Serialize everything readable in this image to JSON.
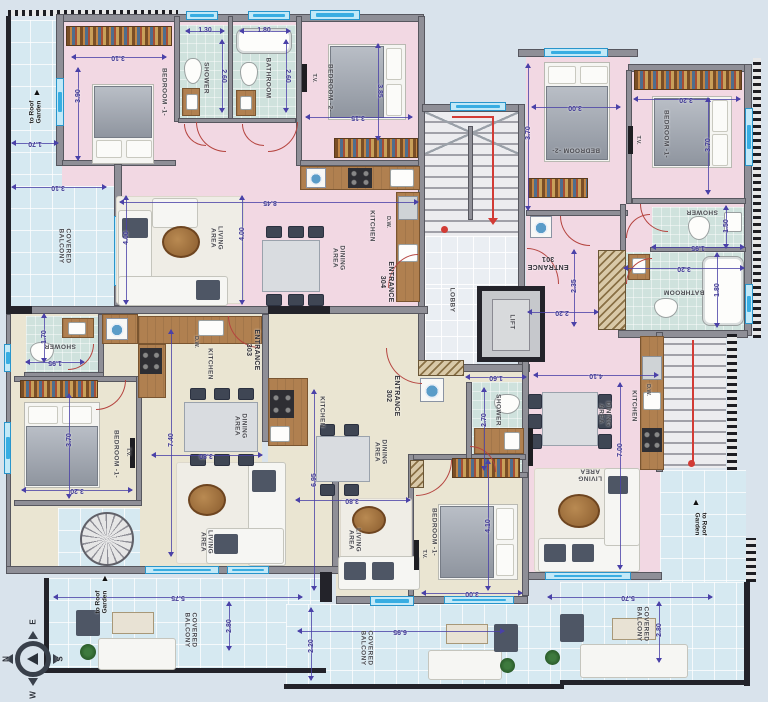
{
  "colors": {
    "pink_unit": "#f2d8e3",
    "beige_unit": "#eae5d2",
    "wet_room_tile": "#cfe2dd",
    "balcony_tile": "#d6e9f1",
    "wall": "#8f8f97",
    "dimension": "#3f3894",
    "door_swing": "#b5443f",
    "window": "#38ade2",
    "stair_path": "#d23b35"
  },
  "labels": [
    {
      "t": "BEDROOM -1-",
      "x": 164,
      "y": 92,
      "r": 90,
      "c": "room"
    },
    {
      "t": "SHOWER",
      "x": 206,
      "y": 78,
      "r": 90,
      "c": "room"
    },
    {
      "t": "BATHROOM",
      "x": 268,
      "y": 78,
      "r": 90,
      "c": "room"
    },
    {
      "t": "BEDROOM -2-",
      "x": 330,
      "y": 88,
      "r": 90,
      "c": "room"
    },
    {
      "t": "LIVING\nAREA",
      "x": 216,
      "y": 238,
      "r": 90,
      "c": "room"
    },
    {
      "t": "DINING\nAREA",
      "x": 338,
      "y": 258,
      "r": 90,
      "c": "room"
    },
    {
      "t": "KITCHEN",
      "x": 372,
      "y": 226,
      "r": 90,
      "c": "room"
    },
    {
      "t": "BEDROOM -2-",
      "x": 576,
      "y": 150,
      "r": 180,
      "c": "room"
    },
    {
      "t": "BEDROOM -1-",
      "x": 666,
      "y": 134,
      "r": 90,
      "c": "room"
    },
    {
      "t": "SHOWER",
      "x": 702,
      "y": 212,
      "r": 180,
      "c": "room"
    },
    {
      "t": "BATHROOM",
      "x": 684,
      "y": 292,
      "r": 180,
      "c": "room"
    },
    {
      "t": "DINING\nAREA",
      "x": 604,
      "y": 414,
      "r": 90,
      "c": "room"
    },
    {
      "t": "KITCHEN",
      "x": 634,
      "y": 406,
      "r": 90,
      "c": "room"
    },
    {
      "t": "LIVING\nAREA",
      "x": 590,
      "y": 474,
      "r": 180,
      "c": "room"
    },
    {
      "t": "LOBBY",
      "x": 452,
      "y": 300,
      "r": 90,
      "c": "room"
    },
    {
      "t": "LIFT",
      "x": 512,
      "y": 322,
      "r": 90,
      "c": "room"
    },
    {
      "t": "SHOWER",
      "x": 60,
      "y": 346,
      "r": 180,
      "c": "room"
    },
    {
      "t": "BEDROOM -1-",
      "x": 116,
      "y": 454,
      "r": 90,
      "c": "room"
    },
    {
      "t": "KITCHEN",
      "x": 210,
      "y": 364,
      "r": 90,
      "c": "room"
    },
    {
      "t": "DINING\nAREA",
      "x": 240,
      "y": 426,
      "r": 90,
      "c": "room"
    },
    {
      "t": "LIVING\nAREA",
      "x": 206,
      "y": 542,
      "r": 90,
      "c": "room"
    },
    {
      "t": "KITCHEN",
      "x": 322,
      "y": 412,
      "r": 90,
      "c": "room"
    },
    {
      "t": "DINING\nAREA",
      "x": 380,
      "y": 452,
      "r": 90,
      "c": "room"
    },
    {
      "t": "LIVING\nAREA",
      "x": 354,
      "y": 540,
      "r": 90,
      "c": "room"
    },
    {
      "t": "BEDROOM -1-",
      "x": 434,
      "y": 532,
      "r": 90,
      "c": "room"
    },
    {
      "t": "SHOWER",
      "x": 498,
      "y": 410,
      "r": 90,
      "c": "room"
    },
    {
      "t": "COVERED\nBALCONY",
      "x": 64,
      "y": 246,
      "r": 90,
      "c": "room"
    },
    {
      "t": "COVERED\nBALCONY",
      "x": 190,
      "y": 630,
      "r": 90,
      "c": "room"
    },
    {
      "t": "COVERED\nBALCONY",
      "x": 366,
      "y": 648,
      "r": 90,
      "c": "room"
    },
    {
      "t": "COVERED\nBALCONY",
      "x": 642,
      "y": 624,
      "r": 90,
      "c": "room"
    },
    {
      "t": "ENTRANCE\n304",
      "x": 386,
      "y": 282,
      "r": 90,
      "c": "ent"
    },
    {
      "t": "ENTRANCE\n301",
      "x": 548,
      "y": 262,
      "r": 180,
      "c": "ent"
    },
    {
      "t": "ENTRANCE\n303",
      "x": 252,
      "y": 350,
      "r": 90,
      "c": "ent"
    },
    {
      "t": "ENTRANCE\n302",
      "x": 392,
      "y": 396,
      "r": 90,
      "c": "ent"
    },
    {
      "t": "T.V.",
      "x": 314,
      "y": 78,
      "r": 90,
      "c": "tiny"
    },
    {
      "t": "T.V.",
      "x": 638,
      "y": 140,
      "r": 90,
      "c": "tiny"
    },
    {
      "t": "T.V.",
      "x": 128,
      "y": 452,
      "r": 90,
      "c": "tiny"
    },
    {
      "t": "T.V.",
      "x": 424,
      "y": 554,
      "r": 90,
      "c": "tiny"
    },
    {
      "t": "D.W.",
      "x": 388,
      "y": 222,
      "r": 90,
      "c": "tiny"
    },
    {
      "t": "D.W.",
      "x": 648,
      "y": 390,
      "r": 90,
      "c": "tiny"
    },
    {
      "t": "D.W.",
      "x": 196,
      "y": 342,
      "r": 90,
      "c": "tiny"
    },
    {
      "t": "to Roof\nGarden",
      "x": 36,
      "y": 112,
      "r": -90,
      "c": "roof"
    },
    {
      "t": "to Roof\nGarden",
      "x": 102,
      "y": 602,
      "r": -90,
      "c": "roof"
    },
    {
      "t": "to Roof\nGarden",
      "x": 700,
      "y": 524,
      "r": 90,
      "c": "roof"
    },
    {
      "t": "▲",
      "x": 37,
      "y": 92,
      "r": 0,
      "c": "tri"
    },
    {
      "t": "▲",
      "x": 105,
      "y": 578,
      "r": 0,
      "c": "tri"
    },
    {
      "t": "▲",
      "x": 696,
      "y": 502,
      "r": 0,
      "c": "tri"
    },
    {
      "t": "E",
      "x": 33,
      "y": 622,
      "r": -90,
      "c": "cl"
    },
    {
      "t": "N",
      "x": 6,
      "y": 659,
      "r": -90,
      "c": "cl"
    },
    {
      "t": "S",
      "x": 60,
      "y": 659,
      "r": -90,
      "c": "cl"
    },
    {
      "t": "W",
      "x": 33,
      "y": 695,
      "r": -90,
      "c": "cl"
    },
    {
      "t": "3.10",
      "x": 118,
      "y": 57,
      "r": 180,
      "c": "dim"
    },
    {
      "t": "3.90",
      "x": 79,
      "y": 96,
      "r": -90,
      "c": "dim"
    },
    {
      "t": "1.70",
      "x": 35,
      "y": 143,
      "r": 180,
      "c": "dim"
    },
    {
      "t": "3.10",
      "x": 58,
      "y": 187,
      "r": 180,
      "c": "dim"
    },
    {
      "t": "1.30",
      "x": 205,
      "y": 31,
      "r": 0,
      "c": "dim"
    },
    {
      "t": "2.60",
      "x": 223,
      "y": 76,
      "r": 90,
      "c": "dim"
    },
    {
      "t": "1.80",
      "x": 264,
      "y": 31,
      "r": 0,
      "c": "dim"
    },
    {
      "t": "2.60",
      "x": 287,
      "y": 76,
      "r": 90,
      "c": "dim"
    },
    {
      "t": "3.15",
      "x": 358,
      "y": 117,
      "r": 180,
      "c": "dim"
    },
    {
      "t": "3.85",
      "x": 379,
      "y": 91,
      "r": 90,
      "c": "dim"
    },
    {
      "t": "8.45",
      "x": 270,
      "y": 202,
      "r": 180,
      "c": "dim"
    },
    {
      "t": "4.00",
      "x": 127,
      "y": 238,
      "r": -90,
      "c": "dim"
    },
    {
      "t": "4.00",
      "x": 243,
      "y": 234,
      "r": -90,
      "c": "dim"
    },
    {
      "t": "3.00",
      "x": 575,
      "y": 107,
      "r": 180,
      "c": "dim"
    },
    {
      "t": "3.70",
      "x": 529,
      "y": 133,
      "r": -90,
      "c": "dim"
    },
    {
      "t": "3.20",
      "x": 686,
      "y": 99,
      "r": 180,
      "c": "dim"
    },
    {
      "t": "3.70",
      "x": 709,
      "y": 145,
      "r": -90,
      "c": "dim"
    },
    {
      "t": "1.50",
      "x": 727,
      "y": 226,
      "r": -90,
      "c": "dim"
    },
    {
      "t": "1.95",
      "x": 698,
      "y": 247,
      "r": 180,
      "c": "dim"
    },
    {
      "t": "3.20",
      "x": 684,
      "y": 268,
      "r": 180,
      "c": "dim"
    },
    {
      "t": "1.80",
      "x": 718,
      "y": 290,
      "r": -90,
      "c": "dim"
    },
    {
      "t": "2.35",
      "x": 575,
      "y": 286,
      "r": -90,
      "c": "dim"
    },
    {
      "t": "2.20",
      "x": 562,
      "y": 312,
      "r": 180,
      "c": "dim"
    },
    {
      "t": "1.60",
      "x": 496,
      "y": 377,
      "r": 180,
      "c": "dim"
    },
    {
      "t": "4.10",
      "x": 596,
      "y": 375,
      "r": 180,
      "c": "dim"
    },
    {
      "t": "7.00",
      "x": 621,
      "y": 450,
      "r": -90,
      "c": "dim"
    },
    {
      "t": "1.70",
      "x": 45,
      "y": 337,
      "r": -90,
      "c": "dim"
    },
    {
      "t": "1.95",
      "x": 55,
      "y": 362,
      "r": 180,
      "c": "dim"
    },
    {
      "t": "3.70",
      "x": 70,
      "y": 440,
      "r": -90,
      "c": "dim"
    },
    {
      "t": "3.20",
      "x": 77,
      "y": 490,
      "r": 180,
      "c": "dim"
    },
    {
      "t": "7.40",
      "x": 172,
      "y": 440,
      "r": -90,
      "c": "dim"
    },
    {
      "t": "3.80",
      "x": 206,
      "y": 455,
      "r": 180,
      "c": "dim"
    },
    {
      "t": "6.95",
      "x": 315,
      "y": 480,
      "r": -90,
      "c": "dim"
    },
    {
      "t": "3.80",
      "x": 352,
      "y": 500,
      "r": 180,
      "c": "dim"
    },
    {
      "t": "2.70",
      "x": 485,
      "y": 420,
      "r": -90,
      "c": "dim"
    },
    {
      "t": "4.10",
      "x": 489,
      "y": 526,
      "r": -90,
      "c": "dim"
    },
    {
      "t": "3.00",
      "x": 472,
      "y": 593,
      "r": 180,
      "c": "dim"
    },
    {
      "t": "5.75",
      "x": 178,
      "y": 597,
      "r": 180,
      "c": "dim"
    },
    {
      "t": "2.80",
      "x": 230,
      "y": 626,
      "r": -90,
      "c": "dim"
    },
    {
      "t": "2.20",
      "x": 312,
      "y": 646,
      "r": -90,
      "c": "dim"
    },
    {
      "t": "6.95",
      "x": 400,
      "y": 631,
      "r": 180,
      "c": "dim"
    },
    {
      "t": "5.70",
      "x": 628,
      "y": 597,
      "r": 180,
      "c": "dim"
    },
    {
      "t": "2.80",
      "x": 660,
      "y": 630,
      "r": -90,
      "c": "dim"
    }
  ],
  "dimlines": [
    {
      "o": "h",
      "x": 72,
      "y": 57,
      "l": 94
    },
    {
      "o": "v",
      "x": 78,
      "y": 68,
      "l": 92
    },
    {
      "o": "h",
      "x": 12,
      "y": 143,
      "l": 46
    },
    {
      "o": "h",
      "x": 12,
      "y": 187,
      "l": 94
    },
    {
      "o": "h",
      "x": 186,
      "y": 31,
      "l": 38
    },
    {
      "o": "v",
      "x": 222,
      "y": 40,
      "l": 72
    },
    {
      "o": "h",
      "x": 240,
      "y": 31,
      "l": 50
    },
    {
      "o": "v",
      "x": 286,
      "y": 40,
      "l": 72
    },
    {
      "o": "h",
      "x": 306,
      "y": 117,
      "l": 106
    },
    {
      "o": "v",
      "x": 378,
      "y": 44,
      "l": 96
    },
    {
      "o": "h",
      "x": 120,
      "y": 202,
      "l": 298
    },
    {
      "o": "v",
      "x": 126,
      "y": 196,
      "l": 108
    },
    {
      "o": "v",
      "x": 242,
      "y": 196,
      "l": 108
    },
    {
      "o": "h",
      "x": 532,
      "y": 107,
      "l": 88
    },
    {
      "o": "v",
      "x": 528,
      "y": 64,
      "l": 146
    },
    {
      "o": "h",
      "x": 634,
      "y": 99,
      "l": 106
    },
    {
      "o": "v",
      "x": 708,
      "y": 98,
      "l": 96
    },
    {
      "o": "v",
      "x": 726,
      "y": 206,
      "l": 42
    },
    {
      "o": "h",
      "x": 652,
      "y": 247,
      "l": 92
    },
    {
      "o": "h",
      "x": 624,
      "y": 268,
      "l": 120
    },
    {
      "o": "v",
      "x": 717,
      "y": 253,
      "l": 74
    },
    {
      "o": "v",
      "x": 574,
      "y": 250,
      "l": 76
    },
    {
      "o": "h",
      "x": 528,
      "y": 312,
      "l": 70
    },
    {
      "o": "h",
      "x": 466,
      "y": 377,
      "l": 60
    },
    {
      "o": "h",
      "x": 534,
      "y": 375,
      "l": 124
    },
    {
      "o": "v",
      "x": 620,
      "y": 383,
      "l": 186
    },
    {
      "o": "v",
      "x": 44,
      "y": 314,
      "l": 48
    },
    {
      "o": "h",
      "x": 26,
      "y": 362,
      "l": 58
    },
    {
      "o": "v",
      "x": 69,
      "y": 394,
      "l": 104
    },
    {
      "o": "h",
      "x": 22,
      "y": 490,
      "l": 110
    },
    {
      "o": "v",
      "x": 171,
      "y": 330,
      "l": 226
    },
    {
      "o": "h",
      "x": 152,
      "y": 455,
      "l": 110
    },
    {
      "o": "v",
      "x": 314,
      "y": 390,
      "l": 200
    },
    {
      "o": "h",
      "x": 296,
      "y": 500,
      "l": 114
    },
    {
      "o": "v",
      "x": 484,
      "y": 388,
      "l": 82
    },
    {
      "o": "v",
      "x": 488,
      "y": 460,
      "l": 130
    },
    {
      "o": "h",
      "x": 422,
      "y": 593,
      "l": 100
    },
    {
      "o": "h",
      "x": 54,
      "y": 597,
      "l": 248
    },
    {
      "o": "v",
      "x": 229,
      "y": 602,
      "l": 48
    },
    {
      "o": "v",
      "x": 311,
      "y": 608,
      "l": 72
    },
    {
      "o": "h",
      "x": 298,
      "y": 631,
      "l": 206
    },
    {
      "o": "h",
      "x": 548,
      "y": 597,
      "l": 164
    },
    {
      "o": "v",
      "x": 659,
      "y": 602,
      "l": 60
    }
  ]
}
